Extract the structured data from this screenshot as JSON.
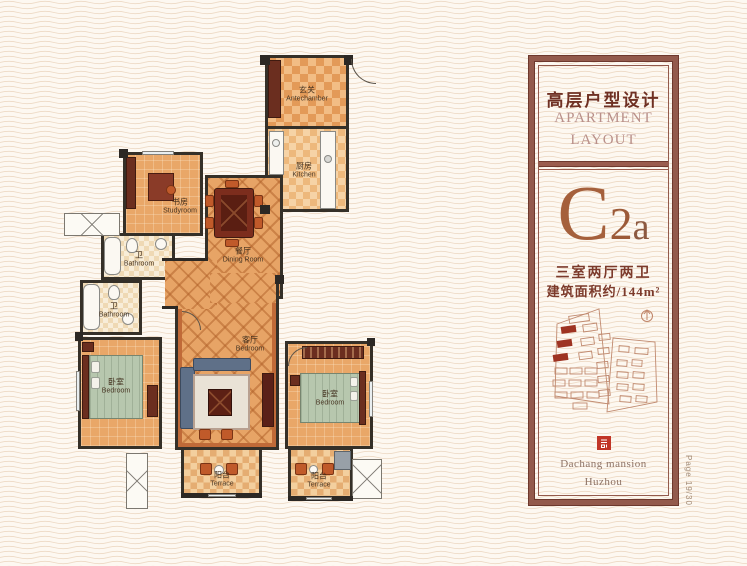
{
  "background": {
    "color": "#fdf8f1",
    "wave_line_color": "#edd9c4"
  },
  "floorplan": {
    "rooms": [
      {
        "cn": "玄关",
        "en": "Antechamber"
      },
      {
        "cn": "厨房",
        "en": "Kitchen"
      },
      {
        "cn": "书房",
        "en": "Studyroom"
      },
      {
        "cn": "餐厅",
        "en": "Dining Room"
      },
      {
        "cn": "卫",
        "en": "Bathroom"
      },
      {
        "cn": "卫",
        "en": "Bathroom"
      },
      {
        "cn": "卧室",
        "en": "Bedroom"
      },
      {
        "cn": "客厅",
        "en": "Bedroom"
      },
      {
        "cn": "卧室",
        "en": "Bedroom"
      },
      {
        "cn": "阳台",
        "en": "Terrace"
      },
      {
        "cn": "阳台",
        "en": "Terrace"
      }
    ],
    "colors": {
      "wall": "#353028",
      "floor": "#e9a768",
      "living_outline": "#c06a38"
    }
  },
  "panel": {
    "title_cn": "高层户型设计",
    "title_en_line1": "APARTMENT",
    "title_en_line2": "LAYOUT",
    "unit_letter": "C",
    "unit_digit": "2",
    "unit_suffix": "a",
    "spec_rooms": "三室两厅两卫",
    "spec_area": "建筑面积约/144m²",
    "brand_line1": "Dachang mansion",
    "brand_line2": "Huzhou",
    "colors": {
      "frame": "#935a4c",
      "title_cn": "#6f3023",
      "title_en": "#b9908a",
      "unit": "#a5603c",
      "seal": "#c13527",
      "map_outline": "#c08a70",
      "map_highlight": "#9e3322"
    }
  },
  "page": {
    "label": "Page 19/30"
  }
}
